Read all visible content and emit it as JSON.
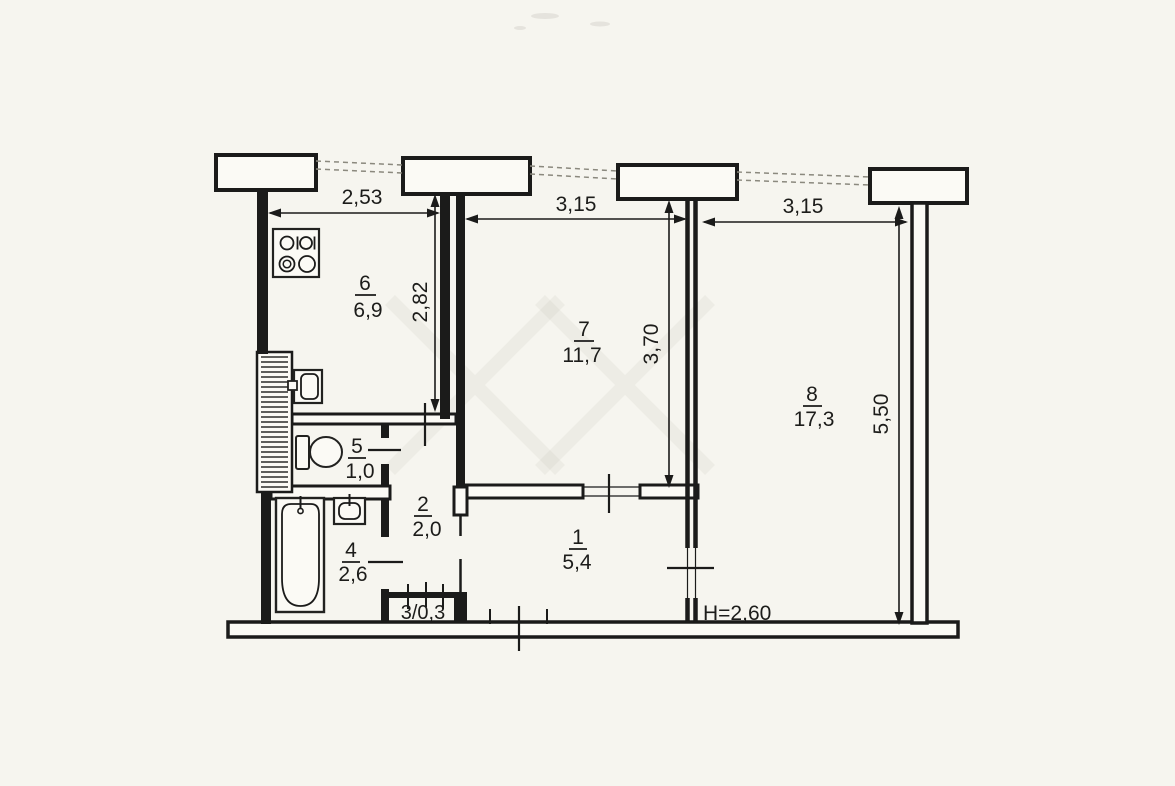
{
  "document": {
    "kind": "apartment floor plan scan",
    "colors": {
      "paper": "#f6f5ef",
      "ink": "#1b1b1a",
      "window_line": "#8b897e"
    }
  },
  "dimensions": {
    "top_left": "2,53",
    "top_middle": "3,15",
    "top_right": "3,15",
    "kitchen_depth": "2,82",
    "room7_depth": "3,70",
    "room8_depth": "5,50",
    "ceiling_height": "H=2,60"
  },
  "rooms": {
    "r1": {
      "number": "1",
      "area": "5,4"
    },
    "r2": {
      "number": "2",
      "area": "2,0"
    },
    "r3": {
      "label": "3/0,3"
    },
    "r4": {
      "number": "4",
      "area": "2,6"
    },
    "r5": {
      "number": "5",
      "area": "1,0"
    },
    "r6": {
      "number": "6",
      "area": "6,9"
    },
    "r7": {
      "number": "7",
      "area": "11,7"
    },
    "r8": {
      "number": "8",
      "area": "17,3"
    }
  }
}
